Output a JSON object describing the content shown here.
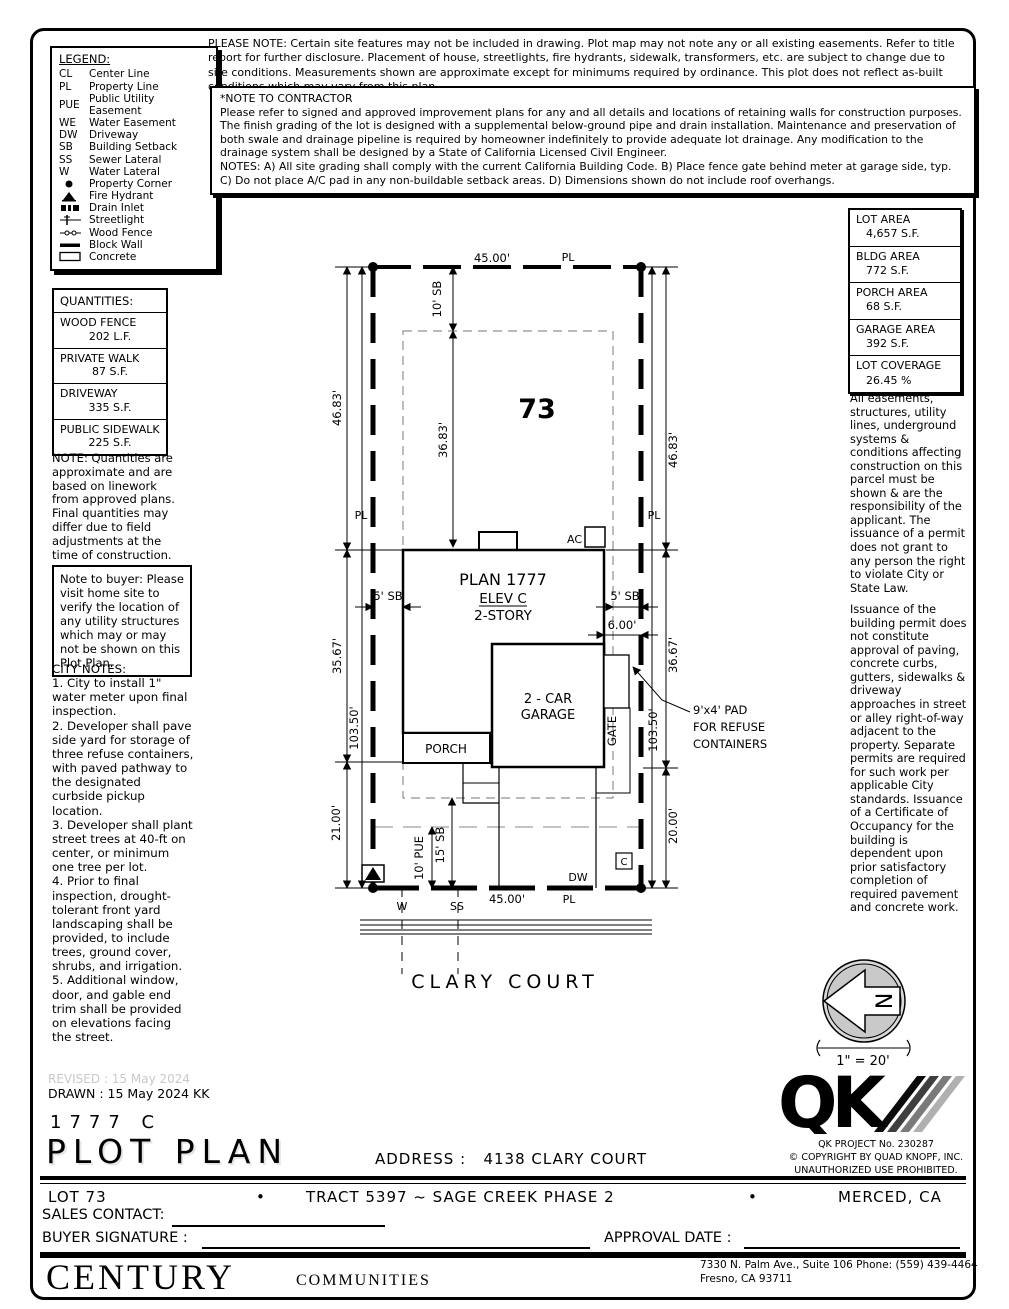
{
  "legend": {
    "title": "LEGEND:",
    "items": [
      {
        "sym": "CL",
        "label": "Center Line"
      },
      {
        "sym": "PL",
        "label": "Property Line"
      },
      {
        "sym": "PUE",
        "label": "Public Utility Easement"
      },
      {
        "sym": "WE",
        "label": "Water Easement"
      },
      {
        "sym": "DW",
        "label": "Driveway"
      },
      {
        "sym": "SB",
        "label": "Building Setback"
      },
      {
        "sym": "SS",
        "label": "Sewer Lateral"
      },
      {
        "sym": "W",
        "label": "Water Lateral"
      },
      {
        "icon": "property-corner",
        "label": "Property Corner"
      },
      {
        "icon": "fire-hydrant",
        "label": "Fire Hydrant"
      },
      {
        "icon": "drain-inlet",
        "label": "Drain Inlet"
      },
      {
        "icon": "streetlight",
        "label": "Streetlight"
      },
      {
        "icon": "wood-fence",
        "label": "Wood Fence"
      },
      {
        "icon": "block-wall",
        "label": "Block Wall"
      },
      {
        "icon": "concrete",
        "label": "Concrete"
      }
    ]
  },
  "please_note": "PLEASE NOTE:  Certain site features may not be included in drawing.  Plot map may not note any or all existing easements. Refer to title report for further disclosure.  Placement of house, streetlights, fire hydrants, sidewalk, transformers, etc. are subject to change due to site conditions.  Measurements shown are approximate except for minimums required by ordinance.  This plot does not reflect as-built conditions which may vary from this plan.",
  "contractor_note": {
    "title": "*NOTE TO CONTRACTOR",
    "body": "Please refer to signed and approved improvement plans for any and all details and locations of retaining walls for construction purposes.\nThe finish grading of the lot is designed with a supplemental below-ground pipe and drain installation.  Maintenance and preservation of both swale and drainage pipeline is required by homeowner indefinitely to provide adequate lot drainage.  Any modification to the drainage system shall be designed by a State of California Licensed Civil Engineer.\nNOTES:  A) All site grading shall comply with the current California Building Code.  B) Place fence gate behind meter at garage side, typ.  C) Do not place A/C pad in any non-buildable setback areas.  D) Dimensions shown do not include roof overhangs."
  },
  "quantities": {
    "title": "QUANTITIES:",
    "rows": [
      {
        "label": "WOOD FENCE",
        "value": "202 L.F."
      },
      {
        "label": "PRIVATE WALK",
        "value": "87 S.F."
      },
      {
        "label": "DRIVEWAY",
        "value": "335 S.F."
      },
      {
        "label": "PUBLIC SIDEWALK",
        "value": "225 S.F."
      }
    ],
    "note": "NOTE: Quantities are approximate and are based on linework from approved plans.  Final quantities may differ due to field adjustments at the time of construction."
  },
  "buyer_note": "Note to buyer: Please visit home site to verify the location of any utility structures which may or may not be shown on this Plot Plan.",
  "city_notes": {
    "title": "CITY NOTES:",
    "body": "1. City to install 1\" water meter upon final inspection.\n2. Developer shall pave side yard for storage of three refuse containers, with paved pathway to the designated curbside pickup location.\n3. Developer shall plant street trees at 40-ft on center, or minimum one tree per lot.\n4. Prior to final inspection, drought-tolerant front yard landscaping shall be provided, to include trees, ground cover, shrubs, and irrigation.\n5. Additional window, door, and gable end trim shall be provided on elevations facing the street."
  },
  "areas": {
    "rows": [
      {
        "label": "LOT AREA",
        "value": "4,657 S.F."
      },
      {
        "label": "BLDG AREA",
        "value": "772 S.F."
      },
      {
        "label": "PORCH AREA",
        "value": "68 S.F."
      },
      {
        "label": "GARAGE AREA",
        "value": "392 S.F."
      },
      {
        "label": "LOT COVERAGE",
        "value": "26.45 %"
      }
    ]
  },
  "right_notes": {
    "p1": "All easements, structures, utility lines, underground systems & conditions affecting construction on this parcel must be shown & are the responsibility of the applicant. The issuance of a permit does not grant to any person the right to violate City or State Law.",
    "p2": "Issuance of the building permit does not constitute approval of paving, concrete curbs, gutters, sidewalks & driveway approaches in street or alley right-of-way adjacent to the property. Separate permits are required for such work per applicable City standards. Issuance of a Certificate of Occupancy for the building is dependent upon prior satisfactory completion of required pavement and concrete work."
  },
  "plot": {
    "labels": {
      "dim_top": "45.00'",
      "pl_top": "PL",
      "sb10": "10' SB",
      "d3683": "36.83'",
      "lot_no": "73",
      "d4683_l": "46.83'",
      "d4683_r": "46.83'",
      "pl_mid_l": "PL",
      "pl_mid_r": "PL",
      "ac": "AC",
      "plan": "PLAN 1777",
      "elev": "ELEV C",
      "story": "2-STORY",
      "sb5_l": "5' SB",
      "sb5_r": "5' SB",
      "d600": "6.00'",
      "d3567": "35.67'",
      "d3667": "36.67'",
      "garage1": "2 - CAR",
      "garage2": "GARAGE",
      "gate": "GATE",
      "pad1": "9'x4' PAD",
      "pad2": "FOR REFUSE",
      "pad3": "CONTAINERS",
      "d10350_l": "103.50'",
      "d10350_r": "103.50'",
      "porch": "PORCH",
      "d2100": "21.00'",
      "d2000": "20.00'",
      "pue10": "10' PUE",
      "sb15": "15' SB",
      "w": "W",
      "ss": "SS",
      "dim_bottom": "45.00'",
      "pl_bottom": "PL",
      "dw": "DW",
      "c": "C",
      "street": "CLARY COURT"
    }
  },
  "north": {
    "n": "N",
    "scale": "1\" = 20'"
  },
  "qk": {
    "letters": "QK",
    "project": "QK PROJECT No. 230287",
    "copyright": "© COPYRIGHT BY QUAD KNOPF, INC.",
    "prohibited": "UNAUTHORIZED USE PROHIBITED."
  },
  "titleblock": {
    "revised": "REVISED :  15 May 2024",
    "drawn": "DRAWN :  15 May 2024   KK",
    "plan_no": "1777  C",
    "title": "PLOT  PLAN",
    "address_label": "ADDRESS :",
    "address_value": "4138 CLARY COURT",
    "lot": "LOT 73",
    "bullet": "•",
    "tract": "TRACT 5397 ~ SAGE CREEK PHASE 2",
    "city": "MERCED, CA",
    "sales_label": "SALES CONTACT:",
    "buyer_label": "BUYER SIGNATURE :",
    "approval_label": "APPROVAL DATE :"
  },
  "footer": {
    "brand": "CENTURY",
    "brand2": "COMMUNITIES",
    "addr1": "7330 N. Palm Ave., Suite 106    Phone:  (559) 439-4464",
    "addr2": "Fresno, CA  93711"
  }
}
